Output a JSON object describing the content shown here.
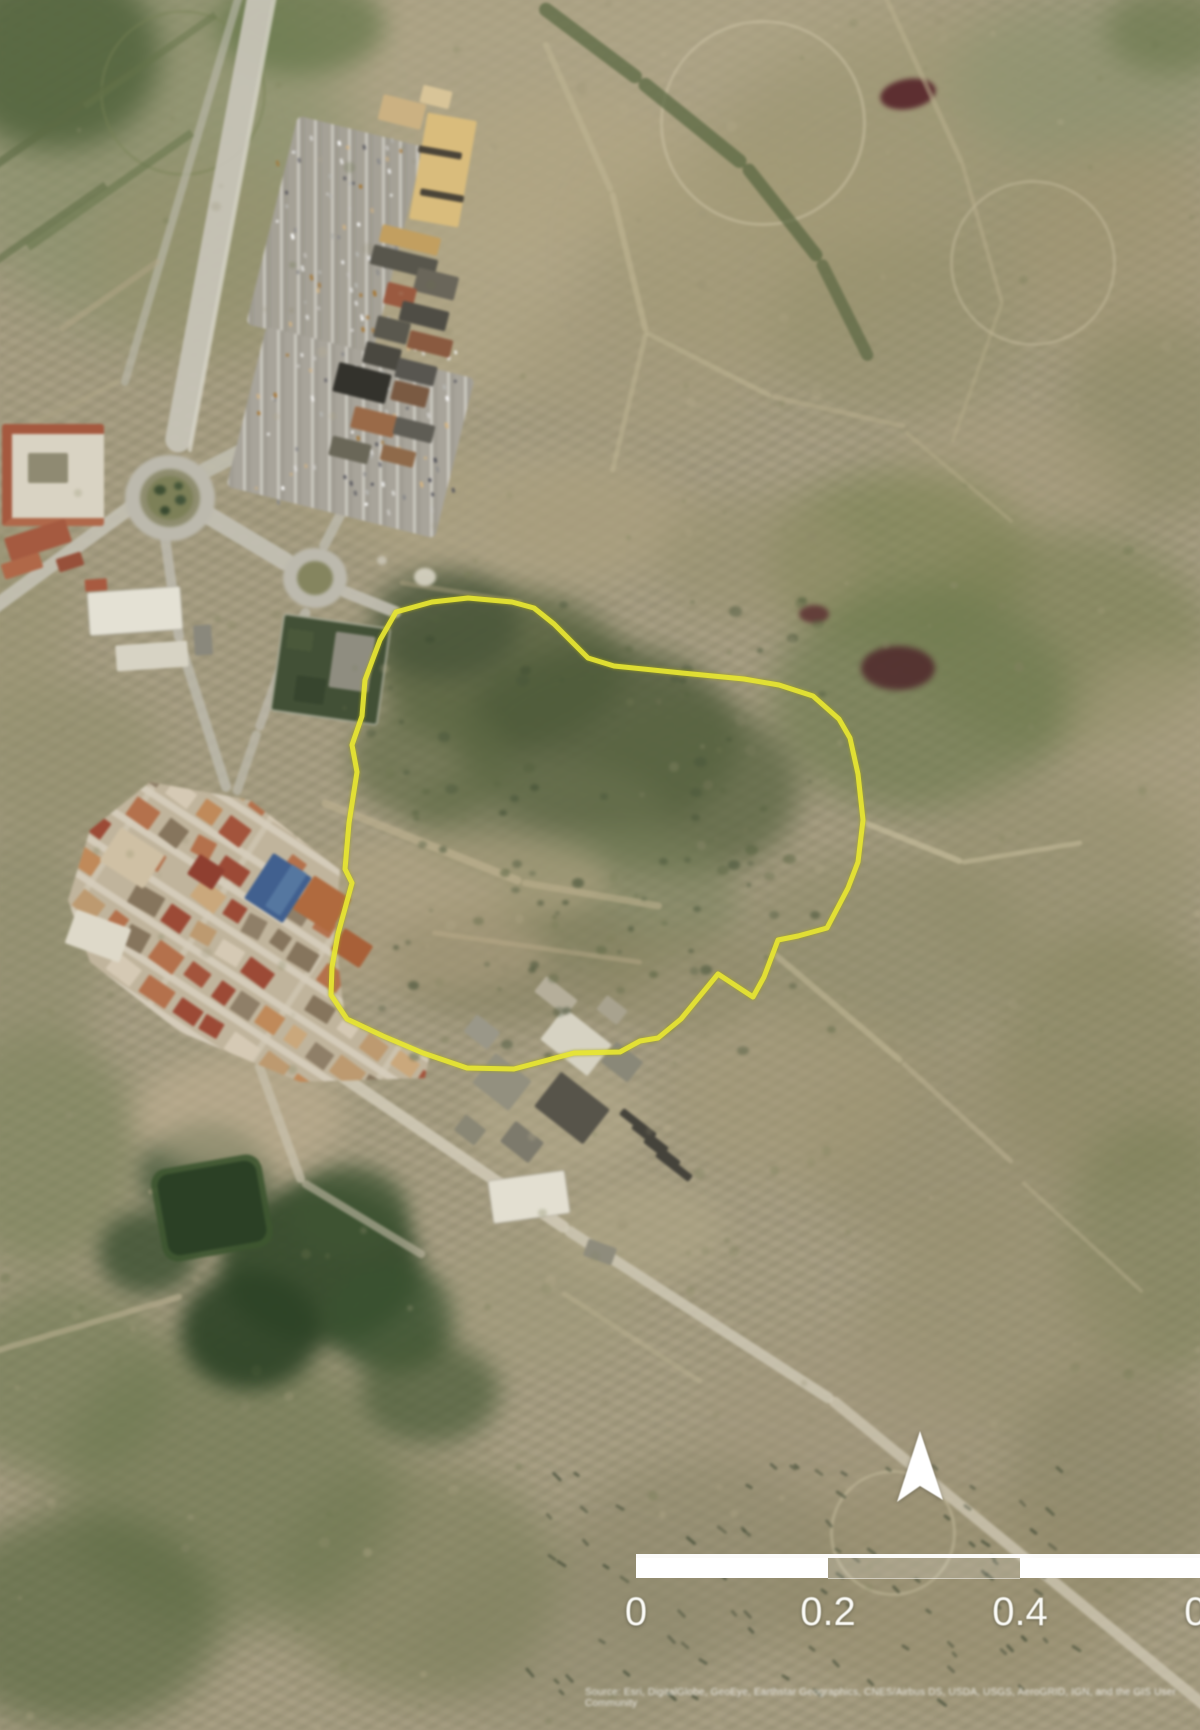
{
  "map": {
    "description": "Aerial satellite view of a town edge with a site boundary outlined in yellow",
    "boundary": {
      "color": "#e6e432",
      "stroke_width": 5,
      "points": [
        [
          396,
          612
        ],
        [
          432,
          602
        ],
        [
          468,
          598
        ],
        [
          512,
          602
        ],
        [
          534,
          608
        ],
        [
          554,
          624
        ],
        [
          571,
          641
        ],
        [
          588,
          658
        ],
        [
          614,
          666
        ],
        [
          682,
          673
        ],
        [
          744,
          679
        ],
        [
          779,
          685
        ],
        [
          813,
          696
        ],
        [
          839,
          719
        ],
        [
          850,
          738
        ],
        [
          858,
          774
        ],
        [
          863,
          820
        ],
        [
          858,
          862
        ],
        [
          848,
          888
        ],
        [
          827,
          928
        ],
        [
          798,
          936
        ],
        [
          778,
          940
        ],
        [
          764,
          977
        ],
        [
          753,
          997
        ],
        [
          718,
          974
        ],
        [
          681,
          1019
        ],
        [
          658,
          1038
        ],
        [
          640,
          1041
        ],
        [
          620,
          1052
        ],
        [
          574,
          1053
        ],
        [
          514,
          1069
        ],
        [
          467,
          1068
        ],
        [
          423,
          1053
        ],
        [
          383,
          1036
        ],
        [
          347,
          1019
        ],
        [
          331,
          995
        ],
        [
          332,
          967
        ],
        [
          338,
          934
        ],
        [
          352,
          883
        ],
        [
          345,
          869
        ],
        [
          349,
          823
        ],
        [
          357,
          772
        ],
        [
          352,
          745
        ],
        [
          362,
          716
        ],
        [
          365,
          680
        ],
        [
          380,
          640
        ]
      ]
    },
    "north_arrow": {
      "icon": "north-arrow-icon",
      "color": "#ffffff"
    },
    "scale_bar": {
      "labels": [
        "0",
        "0.2",
        "0.4",
        "0.6"
      ],
      "tick_positions_px": [
        636,
        828,
        1020,
        1212
      ],
      "bar_color": "#ffffff",
      "segments": [
        "solid",
        "hollow",
        "solid"
      ]
    },
    "attribution": {
      "line1": "Source: Esri, DigitalGlobe, GeoEye, Earthstar Geographics, CNES/Airbus DS, USDA, USGS, AeroGRID, IGN, and the GIS User",
      "line2": "Community"
    }
  }
}
